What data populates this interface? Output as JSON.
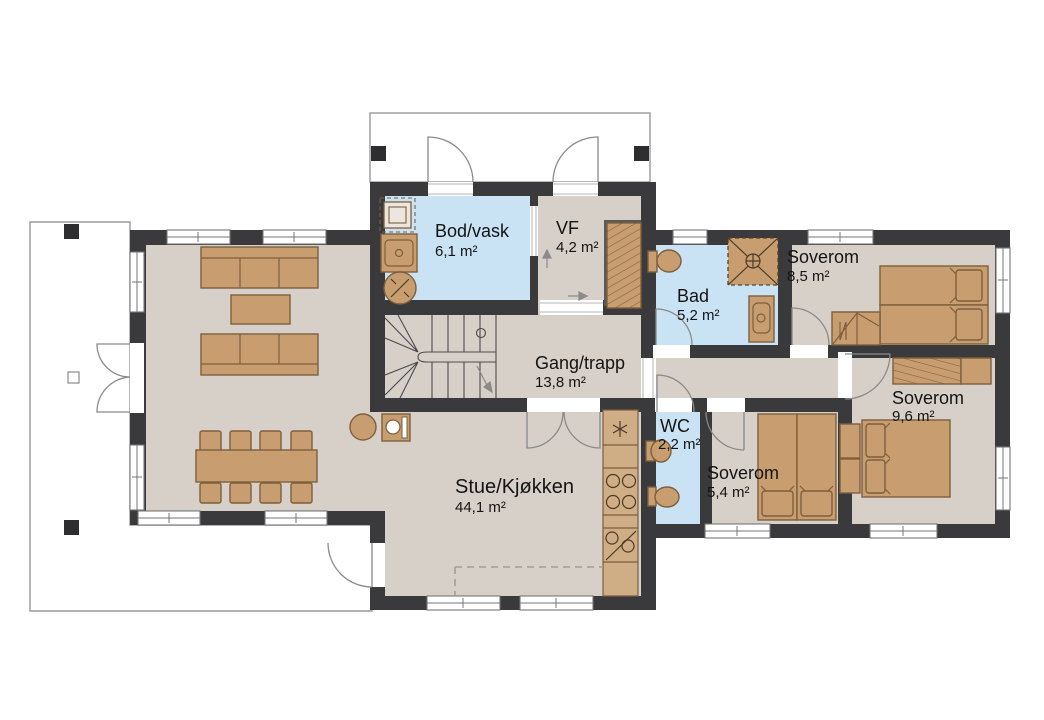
{
  "plan": {
    "title": "House floor plan",
    "rooms": [
      {
        "name": "Bod/vask",
        "area": "6,1 m²",
        "type": "utility",
        "color": "#c9e3f4"
      },
      {
        "name": "VF",
        "area": "4,2 m²",
        "type": "entry",
        "color": "#d6d0c8"
      },
      {
        "name": "Bad",
        "area": "5,2 m²",
        "type": "bath",
        "color": "#c9e3f4"
      },
      {
        "name": "Soverom",
        "area": "8,5 m²",
        "type": "bedroom",
        "color": "#d6d0c8"
      },
      {
        "name": "Gang/trapp",
        "area": "13,8 m²",
        "type": "hall",
        "color": "#d6d0c8"
      },
      {
        "name": "WC",
        "area": "2,2 m²",
        "type": "wc",
        "color": "#c9e3f4"
      },
      {
        "name": "Soverom",
        "area": "5,4 m²",
        "type": "bedroom",
        "color": "#d6d0c8"
      },
      {
        "name": "Soverom",
        "area": "9,6 m²",
        "type": "bedroom",
        "color": "#d6d0c8"
      },
      {
        "name": "Stue/Kjøkken",
        "area": "44,1 m²",
        "type": "living-kitchen",
        "color": "#d6d0c8"
      }
    ],
    "colors": {
      "wall": "#3a3a3c",
      "floor": "#d6d0c8",
      "wet_room": "#c9e3f4",
      "furniture": "#c89e70",
      "furniture_outline": "#7d5f3d",
      "exterior_outline": "#9a9a9a",
      "background": "#ffffff"
    }
  }
}
